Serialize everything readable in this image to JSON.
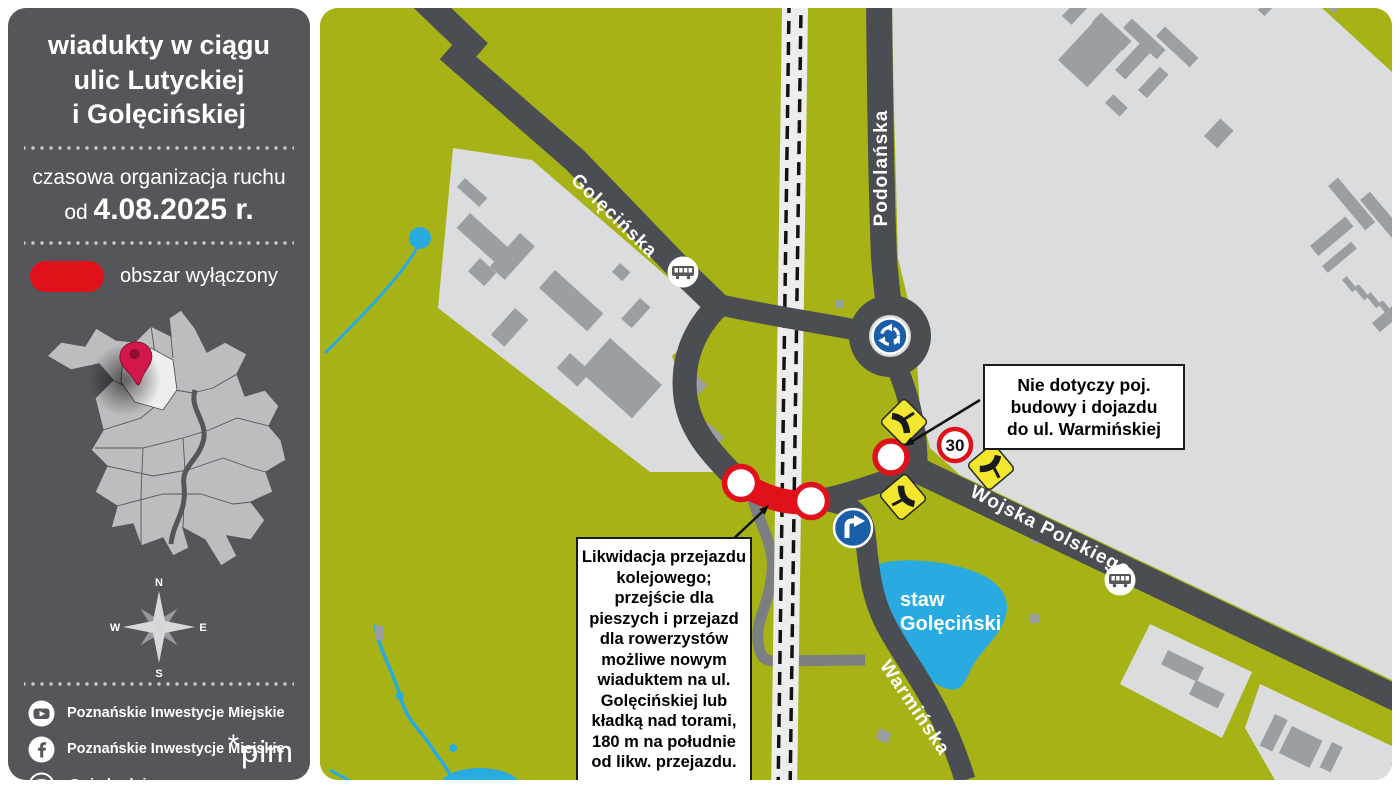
{
  "sidebar": {
    "title_lines": [
      "wiadukty w ciągu",
      "ulic Lutyckiej",
      "i Golęcińskiej"
    ],
    "subtitle": "czasowa organizacja ruchu",
    "date_prefix": "od ",
    "date": "4.08.2025 r.",
    "legend": {
      "label": "obszar wyłączony",
      "swatch_color": "#e0111b",
      "swatch_icon": "closed-area-pill"
    },
    "compass": {
      "n": "N",
      "e": "E",
      "s": "S",
      "w": "W"
    },
    "social": [
      {
        "icon": "youtube-icon",
        "label": "Poznańskie Inwestycje Miejskie"
      },
      {
        "icon": "facebook-icon",
        "label": "Poznańskie Inwestycje Miejskie"
      },
      {
        "icon": "instagram-icon",
        "label": "@pimbuduje"
      }
    ],
    "logo": {
      "star": "*",
      "text": "pim"
    }
  },
  "map": {
    "streets": [
      {
        "name": "Golęcińska"
      },
      {
        "name": "Podolańska"
      },
      {
        "name": "Wojska Polskiego"
      },
      {
        "name": "Warmińska"
      }
    ],
    "pond_label_lines": [
      "staw",
      "Golęciński"
    ],
    "signs": {
      "speed_limit": "30"
    },
    "callouts": {
      "no_entry_note": [
        "Nie dotyczy poj.",
        "budowy i dojazdu",
        "do ul. Warmińskiej"
      ],
      "closure_note": [
        "Likwidacja przejazdu",
        "kolejowego;",
        "przejście dla",
        "pieszych i przejazd",
        "dla rowerzystów",
        "możliwe nowym",
        "wiaduktem na ul.",
        "Golęcińskiej lub",
        "kładką nad torami,",
        "180 m na południe",
        "od likw. przejazdu."
      ]
    },
    "icons": {
      "roundabout": "roundabout-sign-icon",
      "tram_stop": "tram-stop-icon",
      "no_entry": "no-entry-sign-icon",
      "priority_route": "priority-route-sign-icon",
      "turn_right": "turn-right-sign-icon"
    },
    "colors": {
      "map_green": "#a6b216",
      "urban_gray": "#dbdcdd",
      "building_gray": "#9c9fa2",
      "road_dark": "#4a4e53",
      "road_secondary": "#7b7f82",
      "closed_red": "#e0111b",
      "sign_yellow": "#f3e62e",
      "sign_blue": "#1b5ea8",
      "water_blue": "#29abe2",
      "sidebar_gray": "#54565a"
    }
  }
}
